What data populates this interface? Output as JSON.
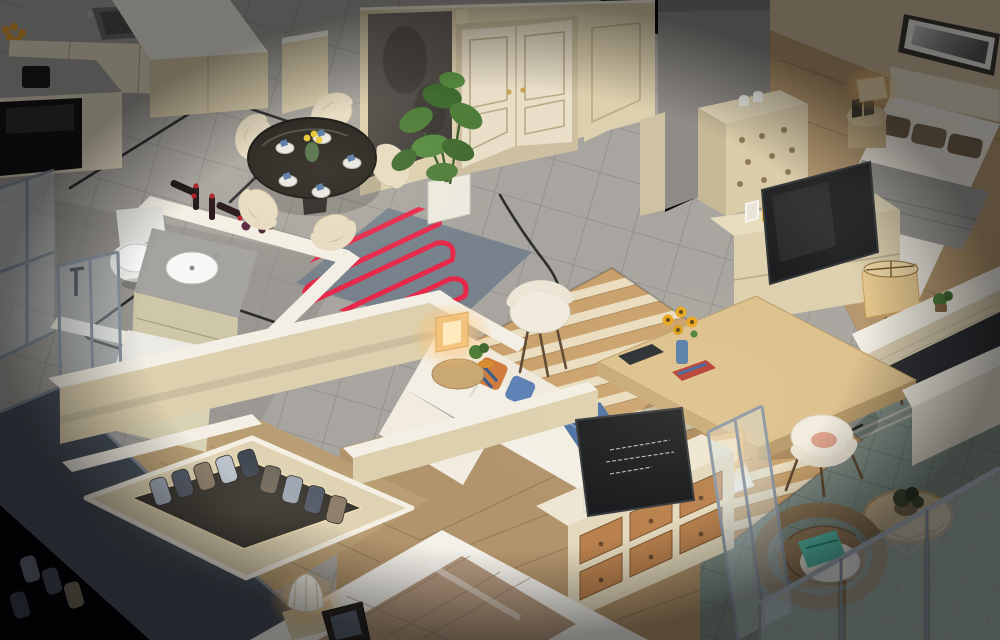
{
  "meta": {
    "kind": "photorealistic 3D isometric dollhouse render of an apartment interior",
    "camera": "elevated isometric cutaway, walls cut to half height",
    "lighting": "warm interior lamps over neutral daylight, dark vignette at corners"
  },
  "palette": {
    "void_black": "#0a0a0c",
    "tile_gray": "#a8a5a0",
    "tile_bath": "#908e89",
    "wood_warm": "#b5976e",
    "wood_master": "#b2946c",
    "wood_closet": "#b99e74",
    "balcony_stone": "#7e8d85",
    "wall_cream": "#ddd0ae",
    "cap_white": "#f3efe4",
    "door_cream": "#e9dfc8",
    "accent_marble": "#5f5a55",
    "counter_marble": "#a5a3a0",
    "glass_table": "#23201c",
    "chair_cream": "#e7dcc2",
    "sofa_white": "#f0eadd",
    "heat_coil_red": "#e6294b",
    "heat_rug_base": "#7c8892",
    "stripe_tan": "#c9a06b",
    "stripe_cream": "#e9dcbf",
    "coffee_wood": "#dcc08c",
    "tv_dark": "#17191c",
    "glow_amber": "#ffc170",
    "plant_green": "#4d7d38",
    "slab_gray": "#49515c",
    "conduit_black": "#17181a",
    "wicker_brown": "#8a7355",
    "cushion_teal": "#57c0ac",
    "throw_gray": "#9a9a98",
    "pillow_brown": "#6e5b48",
    "drawer_wood": "#b9814e",
    "book_red": "#b2372e",
    "sunflower_yellow": "#e8a61e"
  },
  "scene": {
    "rooms": [
      {
        "name": "kitchen",
        "position": "top-left",
        "objects": [
          "marble counters",
          "double sink",
          "black oven",
          "espresso machine",
          "fruit bowl",
          "cream cabinets",
          "island"
        ]
      },
      {
        "name": "dining-area",
        "position": "upper-center-left",
        "objects": [
          "round glass table",
          "5 cream chairs",
          "5 place settings with blue napkins",
          "green vase with yellow flowers",
          "4 wine bottles",
          "grapes and glasses"
        ]
      },
      {
        "name": "entry",
        "position": "top-center",
        "objects": [
          "double door with gold handles",
          "dark marble accent panel",
          "potted monstera"
        ]
      },
      {
        "name": "bathroom-main",
        "position": "mid-left",
        "objects": [
          "toilet",
          "marble vanity with round sink",
          "wine ledge wall"
        ]
      },
      {
        "name": "bathroom-second",
        "position": "lower-left",
        "objects": [
          "vanity sink",
          "glass shower",
          "exterior glazing"
        ]
      },
      {
        "name": "living-room",
        "position": "center",
        "objects": [
          "gray rug with red floor-heating coil",
          "L-shaped white sofa",
          "patterned pillows",
          "2 glowing cube lamps",
          "2 white accent chairs",
          "striped tan rug",
          "wood coffee table",
          "sunflowers in blue vase",
          "notebook",
          "red book",
          "black floor conduits"
        ]
      },
      {
        "name": "bedroom-guest",
        "position": "top-right",
        "objects": [
          "bed with gray throw and brown pillows",
          "panoramic framed art",
          "round nightstand with lit lamp",
          "perforated dresser",
          "TV on cream console",
          "framed photos",
          "yellow dish",
          "tripod floor lamp"
        ]
      },
      {
        "name": "bedroom-master",
        "position": "bottom-center",
        "objects": [
          "bed with quilted tan throw",
          "cream TV dresser with 6 wood drawers",
          "TV seen from back",
          "pleated white lamp",
          "dark photo frame"
        ]
      },
      {
        "name": "walk-in-closet",
        "position": "bottom-left",
        "objects": [
          "wardrobe island",
          "13 hanging garments",
          "warm LED rim light"
        ]
      },
      {
        "name": "balcony",
        "position": "bottom-right",
        "objects": [
          "rattan egg chair",
          "teal cushion",
          "rattan side table with succulent",
          "glass railing",
          "glass partition"
        ]
      }
    ],
    "counts": {
      "dining_chairs": 5,
      "wine_bottles": 4,
      "hanging_garments": 13,
      "lit_lamps": 6,
      "glass_railing_panels": 3
    }
  }
}
